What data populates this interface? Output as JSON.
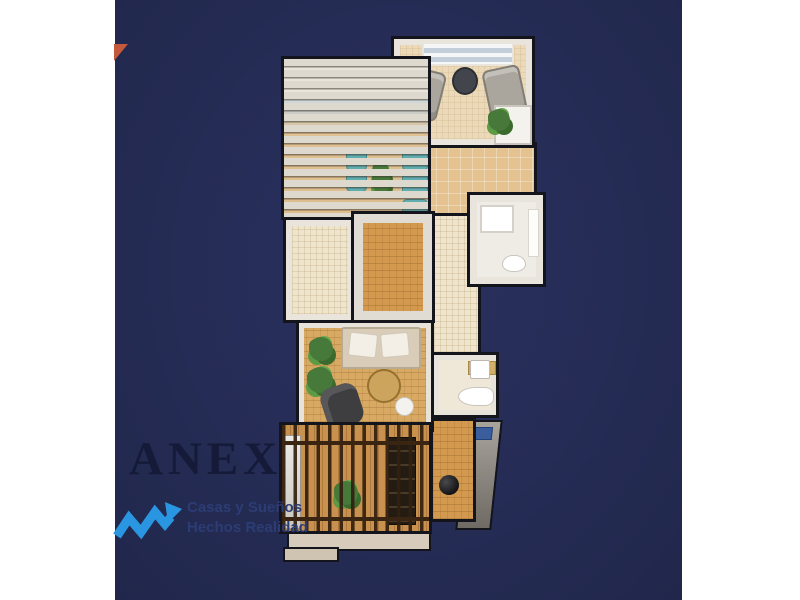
{
  "background": {
    "page": "#ffffff",
    "canvas": "#252c55"
  },
  "logo": {
    "brand": "ANEX",
    "tagline_line1": "Casas y Sueños",
    "tagline_line2": "Hechos Realidad",
    "colors": {
      "brand": "#141a37",
      "tagline": "#2c3c74",
      "zigzag": "#2a96e2"
    }
  },
  "decor": {
    "corner_triangle_color": "#c3583c"
  },
  "floorplan": {
    "type": "3d-top-view-floor-plan-render",
    "colors": {
      "outline": "#14141c",
      "wall": "#e9e5dc",
      "floor_cream": "#efe5cc",
      "floor_wood": "#d2994f",
      "floor_tan": "#e4c391",
      "pergola_slat": "#ded9ce",
      "entry_slat": "#3a2513",
      "lounger_teal": "#5fadb0",
      "plant_green": "#47793a",
      "sofa_gray": "#aaa59d",
      "chair_dark": "#3e3e40",
      "fixture_white": "#ffffff",
      "counter_wood": "#d2af66"
    }
  }
}
